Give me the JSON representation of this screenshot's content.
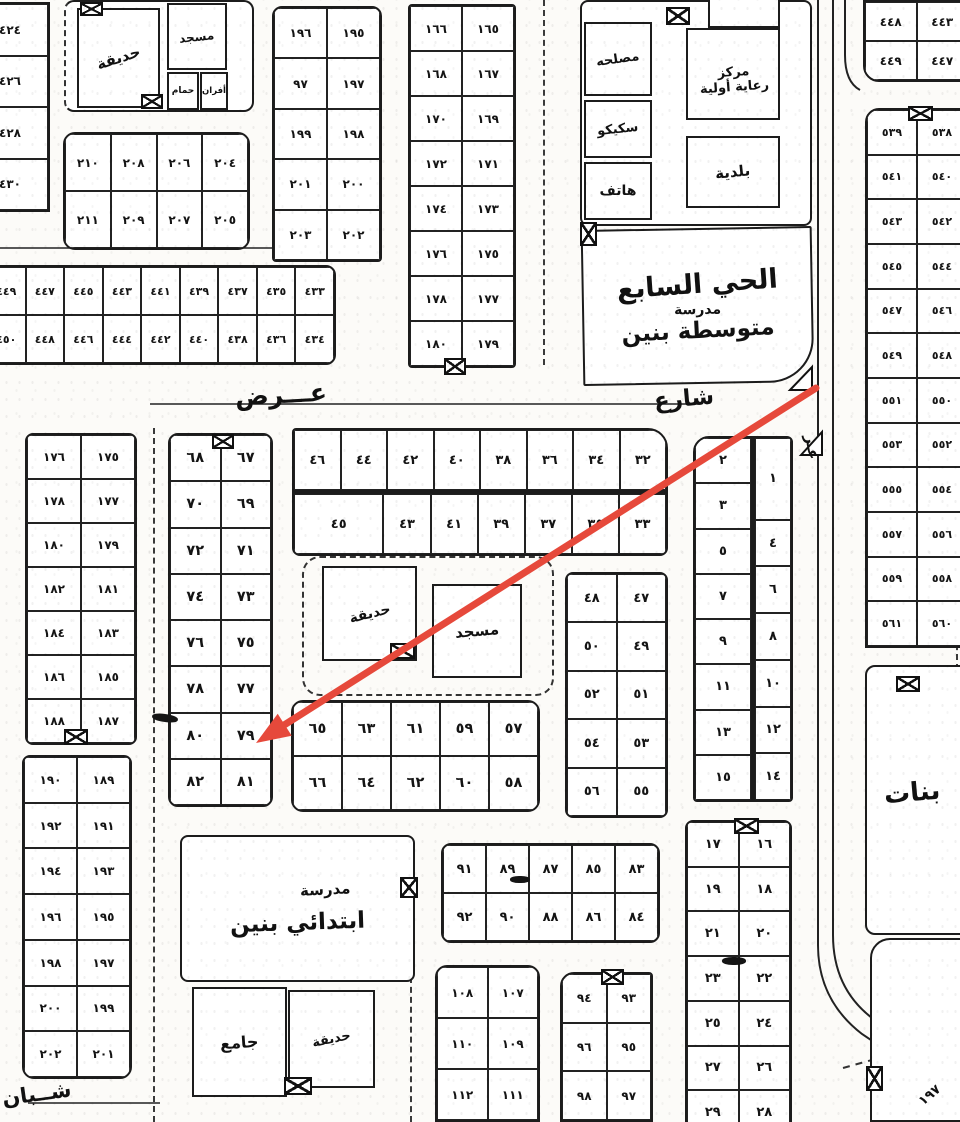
{
  "annotation": {
    "arrow_color": "#e6493b",
    "target_plot": "٧٩"
  },
  "streets": {
    "main_name": "عـــرض",
    "main_label": "شارع",
    "sw_label": "شــبان",
    "east_side_label": "عـر",
    "corner_label": "١٩٧"
  },
  "landmarks": {
    "nw_garden": "حديقة",
    "nw_mosque": "مسجد",
    "nw_bath": "حمام",
    "nw_ovens": "أفران",
    "office": "مصلحه",
    "electric": "سكيكو",
    "phone": "هاتف",
    "care_center_line1": "مركز",
    "care_center_line2": "رعاية أولية",
    "municipality": "بلدية",
    "district_title": "الحي السابع",
    "middle_school_line1": "مدرسة",
    "middle_school_line2": "متوسطة بنين",
    "center_garden": "حديقة",
    "center_mosque": "مسجد",
    "elem_school_line1": "مدرسة",
    "elem_school_line2": "ابتدائي بنين",
    "south_mosque": "جامع",
    "south_garden": "حديقة",
    "girls_label": "بنات"
  },
  "plots": {
    "b424": [
      "٤٢٤",
      "٤٢٦",
      "٤٢٨",
      "٤٣٠"
    ],
    "b449": [
      "٤٤٩",
      "٤٤٧",
      "٤٤٥",
      "٤٤٣",
      "٤٤١",
      "٤٣٩",
      "٤٣٧",
      "٤٣٥",
      "٤٣٣",
      "٤٥٠",
      "٤٤٨",
      "٤٤٦",
      "٤٤٤",
      "٤٤٢",
      "٤٤٠",
      "٤٣٨",
      "٤٣٦",
      "٤٣٤"
    ],
    "b204": [
      "٢١٠",
      "٢٠٨",
      "٢٠٦",
      "٢٠٤",
      "٢١١",
      "٢٠٩",
      "٢٠٧",
      "٢٠٥"
    ],
    "b195": [
      "١٩٦",
      "١٩٥",
      "٩٧",
      "١٩٧",
      "١٩٩",
      "١٩٨",
      "٢٠١",
      "٢٠٠",
      "٢٠٣",
      "٢٠٢"
    ],
    "b165": [
      "١٦٦",
      "١٦٥",
      "١٦٨",
      "١٦٧",
      "١٧٠",
      "١٦٩",
      "١٧٢",
      "١٧١",
      "١٧٤",
      "١٧٣",
      "١٧٦",
      "١٧٥",
      "١٧٨",
      "١٧٧",
      "١٨٠",
      "١٧٩"
    ],
    "b443": [
      "٤٤٨",
      "٤٤٣",
      "٤٤٩",
      "٤٤٧"
    ],
    "b538": [
      "٥٣٩",
      "٥٣٨",
      "٥٤١",
      "٥٤٠",
      "٥٤٣",
      "٥٤٢",
      "٥٤٥",
      "٥٤٤",
      "٥٤٧",
      "٥٤٦",
      "٥٤٩",
      "٥٤٨",
      "٥٥١",
      "٥٥٠",
      "٥٥٣",
      "٥٥٢",
      "٥٥٥",
      "٥٥٤",
      "٥٥٧",
      "٥٥٦",
      "٥٥٩",
      "٥٥٨",
      "٥٦١",
      "٥٦٠"
    ],
    "b67": [
      "٦٨",
      "٦٧",
      "٧٠",
      "٦٩",
      "٧٢",
      "٧١",
      "٧٤",
      "٧٣",
      "٧٦",
      "٧٥",
      "٧٨",
      "٧٧",
      "٨٠",
      "٧٩",
      "٨٢",
      "٨١"
    ],
    "b175": [
      "١٧٦",
      "١٧٥",
      "١٧٨",
      "١٧٧",
      "١٨٠",
      "١٧٩",
      "١٨٢",
      "١٨١",
      "١٨٤",
      "١٨٣",
      "١٨٦",
      "١٨٥",
      "١٨٨",
      "١٨٧"
    ],
    "b189": [
      "١٩٠",
      "١٨٩",
      "١٩٢",
      "١٩١",
      "١٩٤",
      "١٩٣",
      "١٩٦",
      "١٩٥",
      "١٩٨",
      "١٩٧",
      "٢٠٠",
      "١٩٩",
      "٢٠٢",
      "٢٠١"
    ],
    "b32a": [
      "٤٦",
      "٤٤",
      "٤٢",
      "٤٠",
      "٣٨",
      "٣٦",
      "٣٤",
      "٣٢"
    ],
    "b32b": [
      "٤٥",
      "٤٣",
      "٤١",
      "٣٩",
      "٣٧",
      "٣٥",
      "٣٣"
    ],
    "b57": [
      "٦٥",
      "٦٣",
      "٦١",
      "٥٩",
      "٥٧",
      "٦٦",
      "٦٤",
      "٦٢",
      "٦٠",
      "٥٨"
    ],
    "b47": [
      "٤٨",
      "٤٧",
      "٥٠",
      "٤٩",
      "٥٢",
      "٥١",
      "٥٤",
      "٥٣",
      "٥٦",
      "٥٥"
    ],
    "b1L": [
      "٢",
      "٣",
      "٥",
      "٧",
      "٩",
      "١١",
      "١٣",
      "١٥"
    ],
    "b1R": [
      "١",
      "٤",
      "٦",
      "٨",
      "١٠",
      "١٢",
      "١٤"
    ],
    "b16": [
      "١٧",
      "١٦",
      "١٩",
      "١٨",
      "٢١",
      "٢٠",
      "٢٣",
      "٢٢",
      "٢٥",
      "٢٤",
      "٢٧",
      "٢٦",
      "٢٩",
      "٢٨"
    ],
    "b83": [
      "٩١",
      "٨٩",
      "٨٧",
      "٨٥",
      "٨٣",
      "٩٢",
      "٩٠",
      "٨٨",
      "٨٦",
      "٨٤"
    ],
    "b107": [
      "١٠٨",
      "١٠٧",
      "١١٠",
      "١٠٩",
      "١١٢",
      "١١١"
    ],
    "b93": [
      "٩٤",
      "٩٣",
      "٩٦",
      "٩٥",
      "٩٨",
      "٩٧"
    ]
  }
}
